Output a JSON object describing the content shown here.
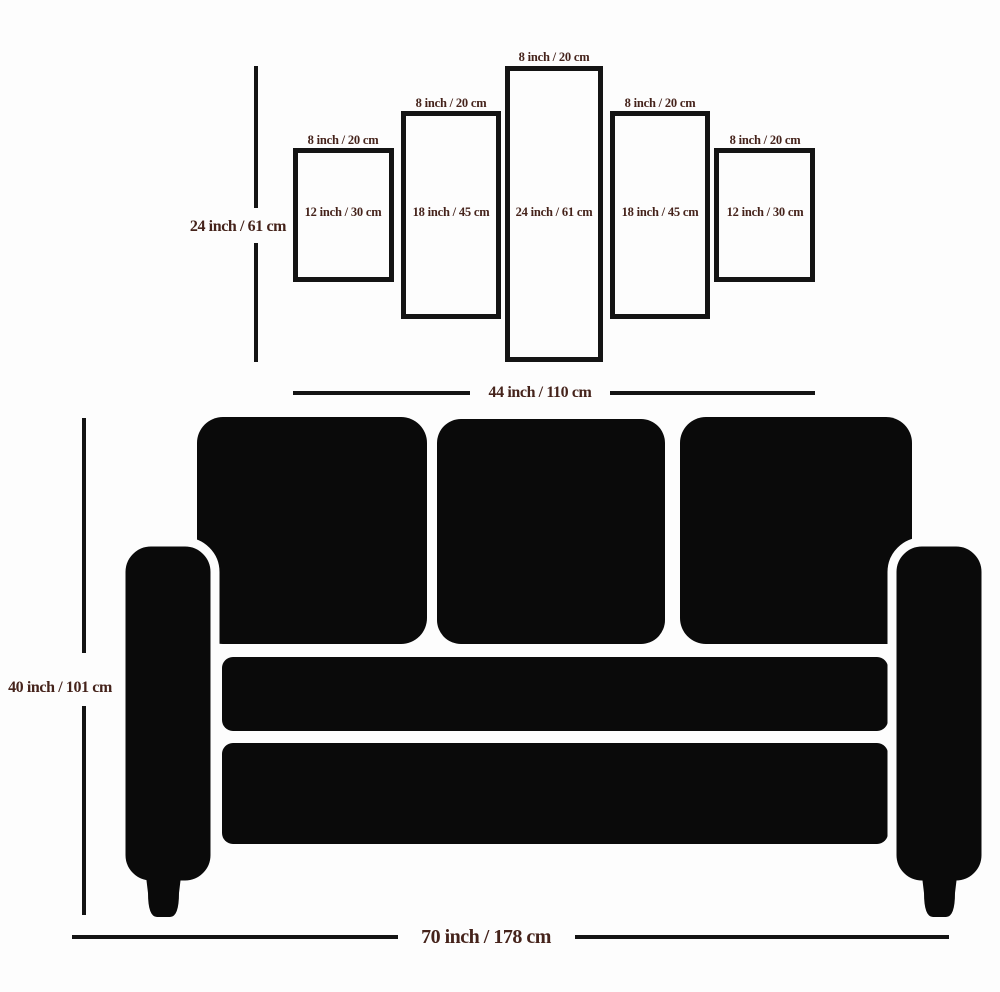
{
  "colors": {
    "background": "#fdfdfd",
    "ink": "#141414",
    "label": "#45231b",
    "sofa": "#0a0a0a"
  },
  "panels": [
    {
      "position": "left-outer",
      "top_label": "8 inch / 20 cm",
      "center_label": "12 inch / 30 cm"
    },
    {
      "position": "left-inner",
      "top_label": "8 inch / 20 cm",
      "center_label": "18 inch / 45 cm"
    },
    {
      "position": "center",
      "top_label": "8 inch / 20 cm",
      "center_label": "24 inch / 61 cm"
    },
    {
      "position": "right-inner",
      "top_label": "8 inch / 20 cm",
      "center_label": "18 inch / 45 cm"
    },
    {
      "position": "right-outer",
      "top_label": "8 inch / 20 cm",
      "center_label": "12 inch / 30 cm"
    }
  ],
  "dimensions": {
    "panel_set_height": "24 inch / 61 cm",
    "panel_set_width": "44 inch / 110 cm",
    "sofa_height": "40 inch / 101 cm",
    "sofa_width": "70 inch / 178 cm"
  }
}
